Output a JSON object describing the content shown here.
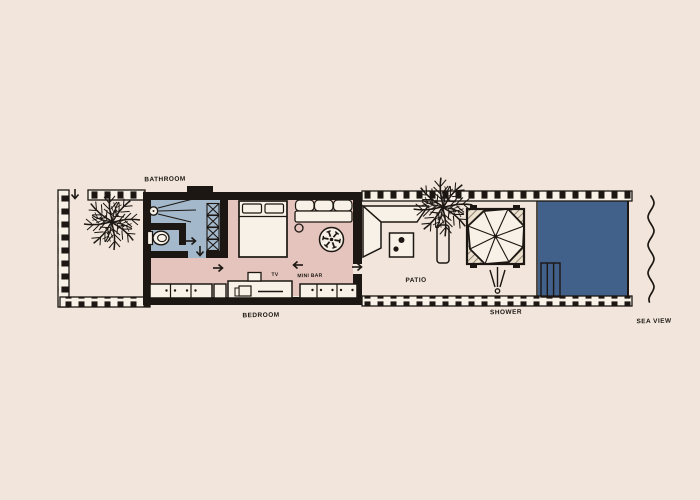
{
  "scene": {
    "type": "hand-drawn villa floor plan illustration",
    "orientation": "long horizontal strip plan with entrance garden at left and sea at right"
  },
  "labels": {
    "bathroom": "BATHROOM",
    "bedroom": "BEDROOM",
    "patio": "PATIO",
    "shower": "SHOWER",
    "sea_view": "SEA VIEW",
    "tv": "TV",
    "mini_bar": "MINI BAR"
  },
  "colors": {
    "background": "#f2e6dc",
    "bathroom_fill": "#a3b8ca",
    "bedroom_fill": "#e4c4bc",
    "pool_fill": "#41608a",
    "paper": "#f8f1e7",
    "ink": "#1c1713"
  },
  "features": {
    "rooms": [
      "bathroom",
      "bedroom",
      "patio",
      "outdoor shower",
      "pool"
    ],
    "furniture": [
      "double bed",
      "sofa",
      "ceiling fan",
      "wardrobe shelves",
      "toilet",
      "indoor shower head",
      "tv console",
      "mini bar cabinets",
      "patio lounge sofa",
      "drinks table",
      "day bed with umbrella",
      "pool steps"
    ],
    "vegetation": [
      "palm tree left garden",
      "palm tree patio"
    ],
    "annotations": [
      "entrance arrow top left",
      "circulation arrows through rooms",
      "sea wave line right edge"
    ]
  }
}
